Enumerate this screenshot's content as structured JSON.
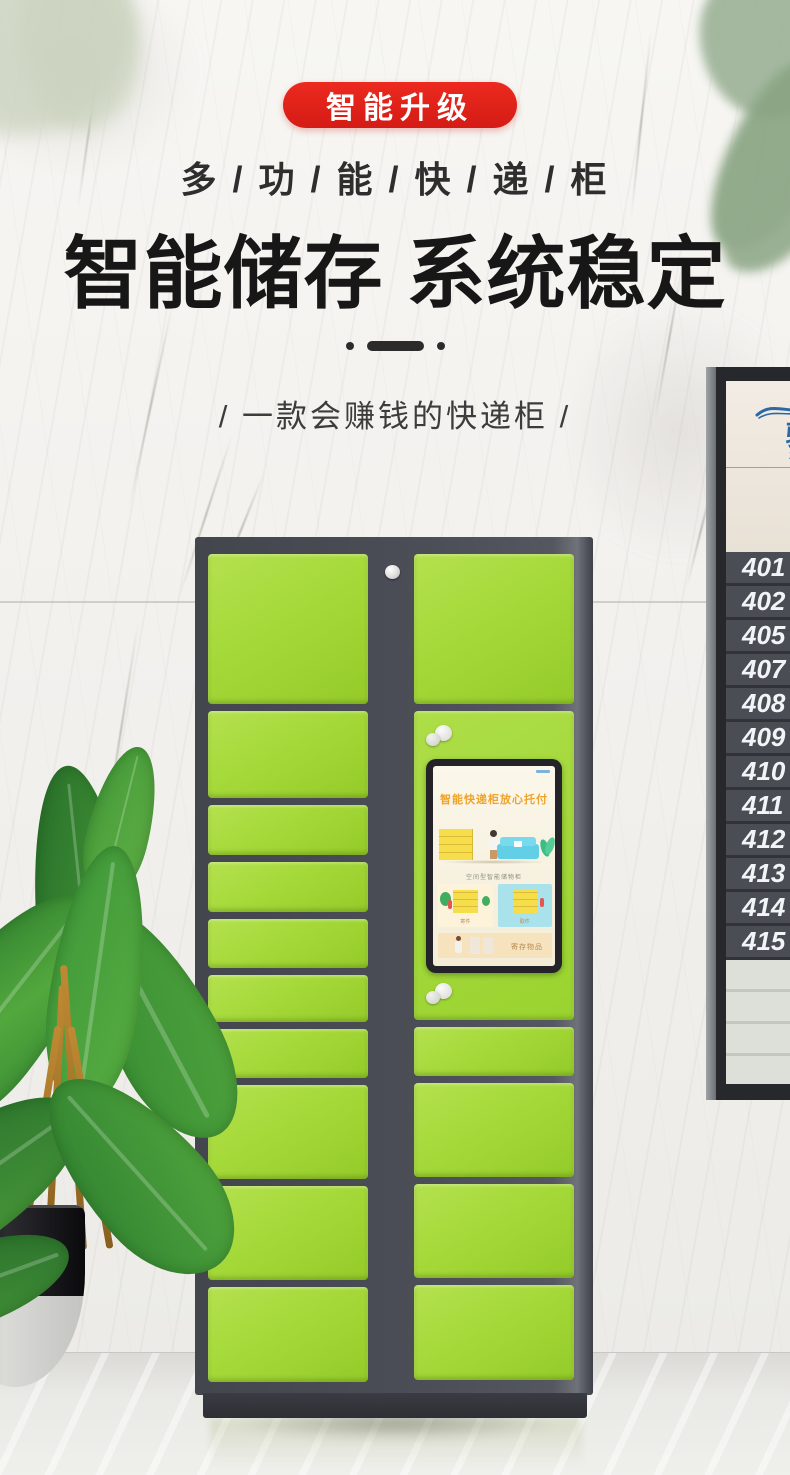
{
  "promo": {
    "badge_label": "智能升级",
    "tagline": "多 / 功 / 能 / 快 / 递 / 柜",
    "headline": "智能储存 系统稳定",
    "subtitle": "/ 一款会赚钱的快递柜 /"
  },
  "colors": {
    "badge_red": "#d41b15",
    "door_green": "#a5d939",
    "cabinet_gray": "#4a4c55",
    "screen_title_orange": "#f0a32a",
    "sign_logo_blue": "#2a69a5"
  },
  "locker_screen": {
    "title": "智能快递柜放心托付",
    "caption": "空间型智能储物柜",
    "card_left_label": "寄件",
    "card_right_label": "取件",
    "banner_label": "寄存物品"
  },
  "sign": {
    "logo_char": "骏",
    "logo_sub": "ZH",
    "numbers": [
      "401",
      "402",
      "405",
      "407",
      "408",
      "409",
      "410",
      "411",
      "412",
      "413",
      "414",
      "415"
    ]
  }
}
